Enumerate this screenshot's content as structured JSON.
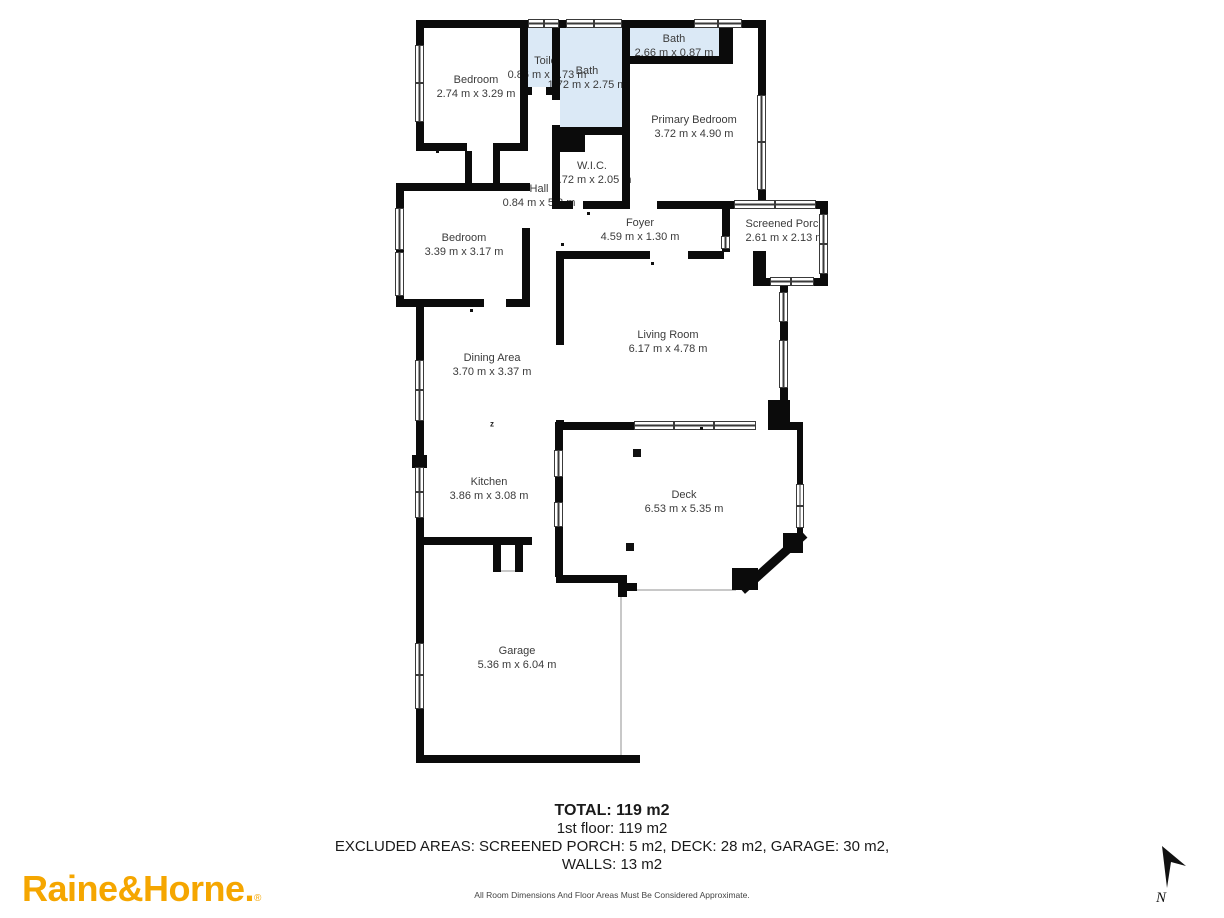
{
  "rooms": [
    {
      "id": "bedroom-1",
      "name": "Bedroom",
      "dims": "2.74 m x 3.29 m"
    },
    {
      "id": "toilet",
      "name": "Toilet",
      "dims": "0.86 m x 1.73 m"
    },
    {
      "id": "bath-1",
      "name": "Bath",
      "dims": "1.72 m x 2.75 m"
    },
    {
      "id": "bath-2",
      "name": "Bath",
      "dims": "2.66 m x 0.87 m"
    },
    {
      "id": "primary-bedroom",
      "name": "Primary Bedroom",
      "dims": "3.72 m x 4.90 m"
    },
    {
      "id": "wic",
      "name": "W.I.C.",
      "dims": "1.72 m x 2.05 m"
    },
    {
      "id": "hall",
      "name": "Hall",
      "dims": "0.84 m x 5.8 m"
    },
    {
      "id": "bedroom-2",
      "name": "Bedroom",
      "dims": "3.39 m x 3.17 m"
    },
    {
      "id": "foyer",
      "name": "Foyer",
      "dims": "4.59 m x 1.30 m"
    },
    {
      "id": "screened-porch",
      "name": "Screened Porch",
      "dims": "2.61 m x 2.13 m"
    },
    {
      "id": "living-room",
      "name": "Living Room",
      "dims": "6.17 m x 4.78 m"
    },
    {
      "id": "dining-area",
      "name": "Dining Area",
      "dims": "3.70 m x 3.37 m"
    },
    {
      "id": "kitchen",
      "name": "Kitchen",
      "dims": "3.86 m x 3.08 m"
    },
    {
      "id": "deck",
      "name": "Deck",
      "dims": "6.53 m x 5.35 m"
    },
    {
      "id": "garage",
      "name": "Garage",
      "dims": "5.36 m x 6.04 m"
    }
  ],
  "summary": {
    "total": "TOTAL: 119 m2",
    "floor": "1st floor: 119 m2",
    "excluded_line1": "EXCLUDED AREAS: SCREENED PORCH: 5 m2, DECK: 28 m2, GARAGE: 30 m2,",
    "excluded_line2": "WALLS: 13 m2",
    "disclaimer": "All Room Dimensions And Floor Areas Must Be Considered Approximate."
  },
  "branding": {
    "logo_text": "Raine&Horne.",
    "registered_mark": "®",
    "logo_color": "#f5a600"
  },
  "compass": {
    "label": "N"
  },
  "decorations": {
    "sleep_marker": "z"
  },
  "colors": {
    "wall": "#0b0b0b",
    "wet_room_fill": "#dbe9f6",
    "label_text": "#3b3b3b"
  }
}
